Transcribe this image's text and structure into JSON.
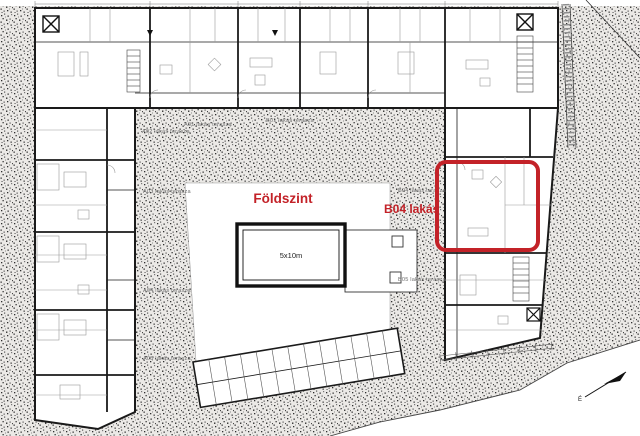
{
  "plan": {
    "floor_label": "Földszint",
    "apartment_label": "B04 lakás",
    "pool_size_label": "5x10m",
    "north_label": "É",
    "highlight_color": "#c32228",
    "terrace_label_color": "#6e6e6e",
    "wall_color": "#1a1a1a",
    "terrace_labels": [
      {
        "text": "A02 lakás terasza"
      },
      {
        "text": "A01 lakás terasza"
      },
      {
        "text": "B01 lakás terasza"
      },
      {
        "text": "A03 lakás terasza"
      },
      {
        "text": "B04 lakás terasza"
      },
      {
        "text": "A04 lakás terasza"
      },
      {
        "text": "B05 lakás terasza"
      },
      {
        "text": "A05 lakás terasza"
      }
    ]
  }
}
